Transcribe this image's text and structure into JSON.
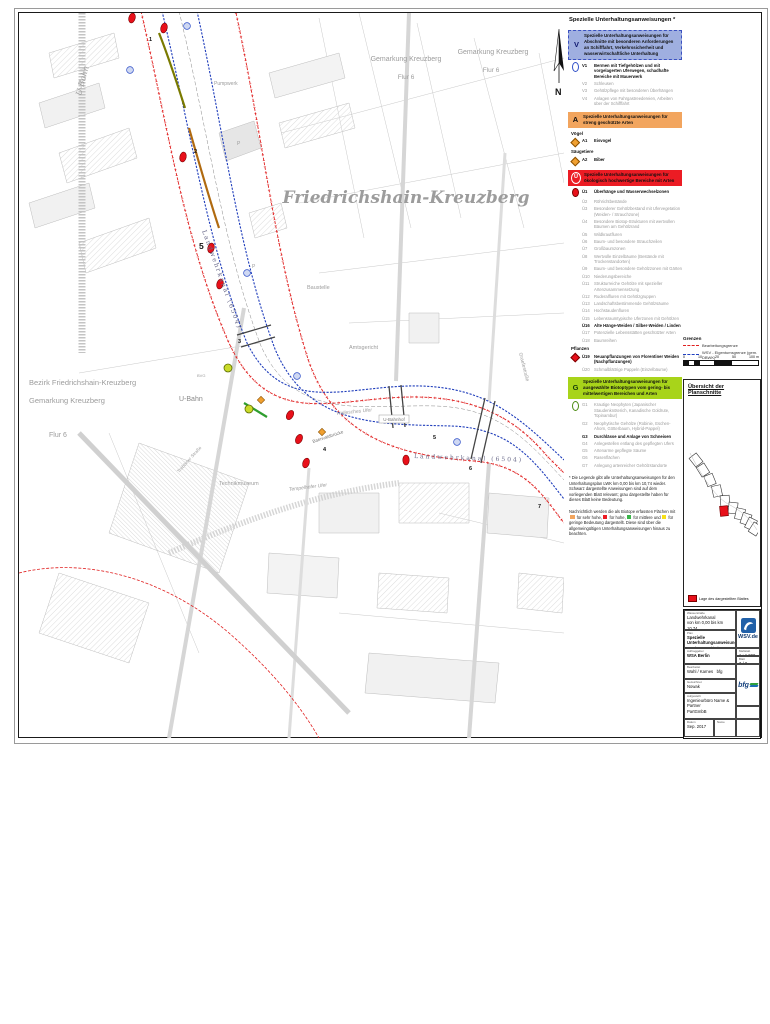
{
  "map": {
    "labels": {
      "district": "Friedrichshain-Kreuzberg",
      "gemarkung1": "Gemarkung Kreuzberg",
      "flur1": "Flur 6",
      "gemarkung2": "Gemarkung Kreuzberg",
      "flur2": "Flur 6",
      "bezirk": "Bezirk Friedrichshain-Kreuzberg",
      "gemarkung3": "Gemarkung Kreuzberg",
      "flur3": "Flur 6",
      "ubahn1": "U-Bahn",
      "ubahn2": "U-Bahn",
      "pumpwerk": "Pumpwerk",
      "baustelle": "Baustelle",
      "amtsgericht": "Amtsgericht",
      "technikmuseum": "Technikmuseum",
      "hallesches_ufer": "Hallesches Ufer",
      "tempelhofer_ufer": "Tempelhofer Ufer",
      "ubahnhof": "U-Bahnhof",
      "bruecke": "Baerwaldbrücke",
      "kanal1": "Landwehrkanal (6504)",
      "kanal2": "Landwehrkanal (6504)",
      "trebbiner": "Trebbiner Straße",
      "graefe": "Graefestraße",
      "bvg": "BVG",
      "p1": "P",
      "p2": "P",
      "north": "N",
      "nums": {
        "n1": "1",
        "n2": "2",
        "big5": "5",
        "n3": "3",
        "n4": "4",
        "n5": "5",
        "n6": "6",
        "n7": "7"
      }
    }
  },
  "legend": {
    "title": "Spezielle Unterhaltungsanweisungen *",
    "v": {
      "code": "V",
      "banner": "Spezielle Unterhaltungsanweisungen für Abschnitte mit besonderen Anforderungen an Schifffahrt, Verkehrssicherheit und wasserwirtschaftliche Unterhaltung",
      "items": [
        {
          "code": "V1",
          "text": "Bermen mit Tiefgehölzen und mit vorgelagerten Uferwegen, schadhafte Bereiche mit Mauerwerk"
        },
        {
          "code": "V2",
          "text": "Schleusen"
        },
        {
          "code": "V3",
          "text": "Gehölzpflege mit besonderen Überhängen"
        },
        {
          "code": "V4",
          "text": "Anlagen von Fahrgastreedereien, Arbeiten über der Schifffahrt"
        }
      ]
    },
    "a": {
      "code": "A",
      "banner": "Spezielle Unterhaltungsanweisungen für streng geschützte Arten",
      "group1": "Vögel",
      "item1": {
        "code": "A1",
        "text": "Eisvogel"
      },
      "group2": "Säugetiere",
      "item2": {
        "code": "A2",
        "text": "Biber"
      }
    },
    "ue": {
      "code": "Ü",
      "banner": "Spezielle Unterhaltungsanweisungen für ökologisch hochwertige Bereiche mit Arten",
      "items": [
        {
          "code": "Ü1",
          "text": "Überhänge und Wasserwechselzonen"
        },
        {
          "code": "Ü2",
          "text": "Röhrichtbestände"
        },
        {
          "code": "Ü3",
          "text": "Besonderer Gehölzbestand mit Ufervegetation (Weiden- / Strauchzone)"
        },
        {
          "code": "Ü4",
          "text": "Besondere Biotop-Strukturen mit wertvollen Bäumen am Gehölzrand"
        },
        {
          "code": "Ü5",
          "text": "Wildkrautfluren"
        },
        {
          "code": "Ü6",
          "text": "Baum- und besondere Strauchzeilen"
        },
        {
          "code": "Ü7",
          "text": "Großbaumzonen"
        },
        {
          "code": "Ü8",
          "text": "Wertvolle Einzelbäume (Bestände mit Trockenstandorten)"
        },
        {
          "code": "Ü9",
          "text": "Baum- und besondere Gehölzzonen mit Gärten"
        },
        {
          "code": "Ü10",
          "text": "Niederungsbereiche"
        },
        {
          "code": "Ü11",
          "text": "Strukturreiche Gehölze mit spezieller Artenzusammensetzung"
        },
        {
          "code": "Ü12",
          "text": "Ruderalfluren mit Gehölzgruppen"
        },
        {
          "code": "Ü13",
          "text": "Landschaftsbestimmende Gehölzsäume"
        },
        {
          "code": "Ü14",
          "text": "Hochstaudenfluren"
        },
        {
          "code": "Ü15",
          "text": "Lebensraumtypische Uferzonen mit Gehölzen"
        },
        {
          "code": "Ü16",
          "text": "Alte Hänge-Weiden / Silber-Weiden / Linden"
        },
        {
          "code": "Ü17",
          "text": "Potenzielle Lebensstätten geschützter Arten"
        },
        {
          "code": "Ü18",
          "text": "Baumreihen"
        }
      ],
      "plants_heading": "Pflanzen",
      "plant_items": [
        {
          "code": "Ü19",
          "text": "Neuanpflanzungen von Florentiner Weiden (Nachpflanzungen)"
        },
        {
          "code": "Ü20",
          "text": "Schmalblättrige Pappeln (Einzelbäume)"
        }
      ]
    },
    "g": {
      "code": "G",
      "banner": "Spezielle Unterhaltungsanweisungen für ausgewählte Biotoptypen vom gering- bis mittelwertigen Bereichen und Arten",
      "items": [
        {
          "code": "G1",
          "text": "Krautige Neophyten (Japanischer Staudenknöterich, Kanadische Goldrute, Topinambur)"
        },
        {
          "code": "G2",
          "text": "Neophytische Gehölze (Robinie, Eschen-Ahorn, Götterbaum, Hybrid-Pappel)"
        },
        {
          "code": "G3",
          "text": "Durchlässe und Anlage von Schneisen"
        },
        {
          "code": "G4",
          "text": "Anlegestellen entlang des gepflegten Ufers"
        },
        {
          "code": "G5",
          "text": "Artenarme gepflegte Säume"
        },
        {
          "code": "G6",
          "text": "Rasenflächen"
        },
        {
          "code": "G7",
          "text": "Anlegung artenreicher Gehölzstandorte"
        }
      ]
    },
    "footnote": "* Die Legende gibt alle Unterhaltungsanweisungen für den Unterhaltungsplan LWK km 0,00 bis km 10,74 wieder. Schwarz dargestellte Anweisungen sind auf dem vorliegenden Blatt relevant; grau dargestellte haben für dieses Blatt keine Bedeutung.",
    "note2": {
      "p1": "Nachrichtlich werden die als Biotope erfassten Flächen mit",
      "p2": "für sehr hohe,",
      "p3": "für hohe,",
      "p4": "für mittlere und",
      "p5": "für geringe Bedeutung dargestellt. Diese sind über die allgemeingültigen Unterhaltungsanweisungen hinaus zu beachten."
    }
  },
  "grenzen": {
    "title": "Grenzen",
    "rows": [
      {
        "text": "Bearbeitungsgrenze"
      },
      {
        "text": "WSV - Eigentumsgrenze (gem. DBWK)"
      }
    ]
  },
  "scalebar": {
    "labels": [
      "0",
      "10",
      "20",
      "50",
      "100 m"
    ]
  },
  "overview": {
    "title": "Übersicht der Planschnitte",
    "note": "Lage des dargestellten Blattes"
  },
  "titleblock": {
    "ws_label": "Wasserstraße",
    "ws_value1": "Landwehrkanal",
    "ws_value2": "von km 0,00 bis km 10,74",
    "plan_label": "Plan",
    "plan_value1": "Spezielle Unterhaltungsanweisungen",
    "plan_value2": "von km 2,78 bis km 3,78",
    "client_label": "Auftraggeber",
    "client_value": "WSA Berlin",
    "scale_label": "Maßstab",
    "scale_value": "1 : 1.000",
    "sheet_label": "Blatt",
    "sheet_value": "3 / 8",
    "edit_label": "Bearbeitet",
    "edit_value": "Wahl / Karnes",
    "edit_extra": "bfg",
    "drawn_label": "Gezeichnet",
    "drawn_value": "Nowak",
    "firm_label": "Aufgestellt",
    "firm_value1": "Ingenieurbüro Name & Partner",
    "firm_value2": "PartGmbB",
    "date_label": "Datum",
    "date_value": "Sep. 2017",
    "name_label": "Name",
    "wsv_logo_text": "WSV.de",
    "bfg_logo_text": "bfg"
  }
}
